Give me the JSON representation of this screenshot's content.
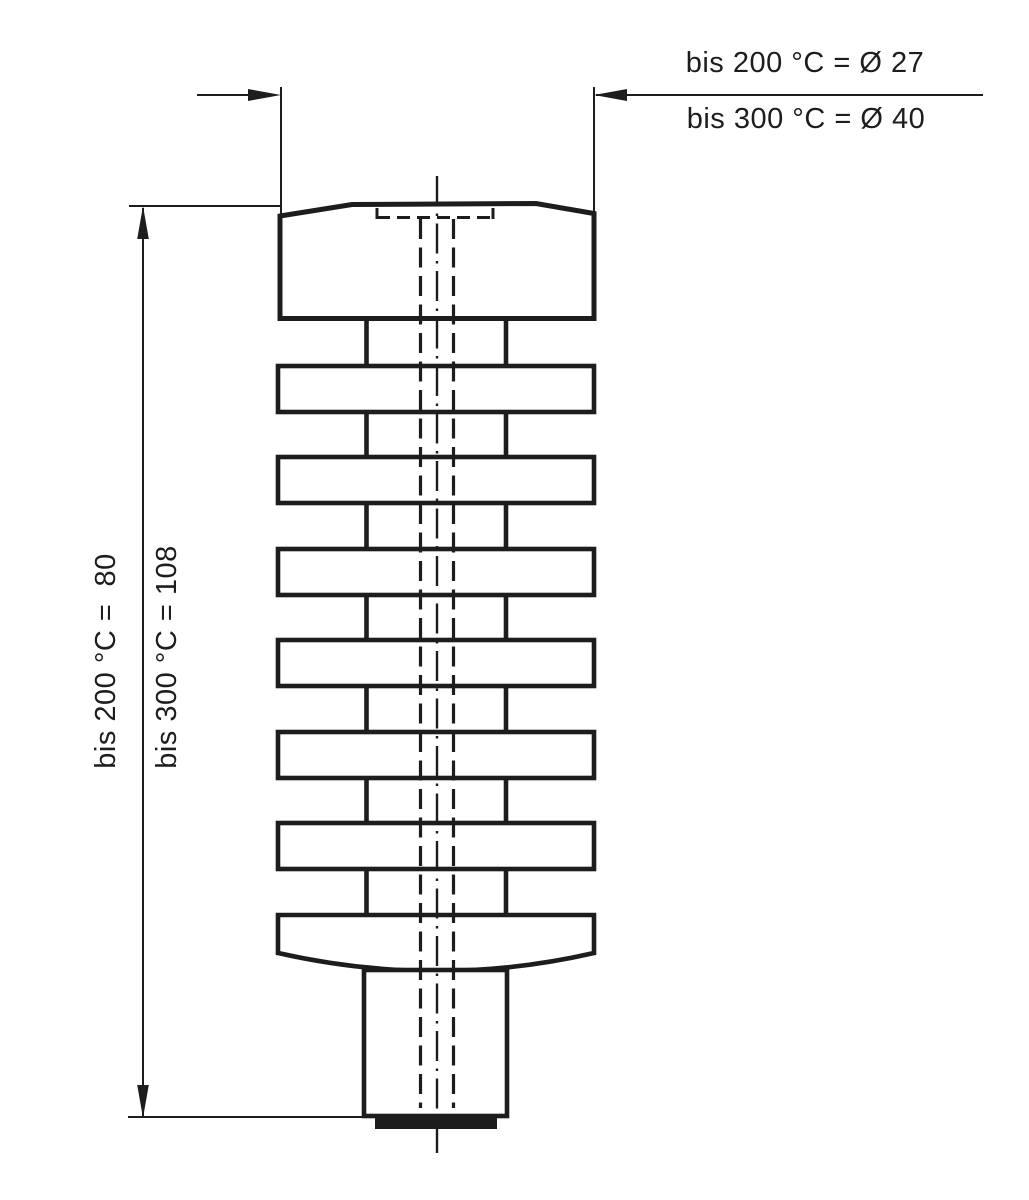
{
  "drawing": {
    "description": "technical outline drawing of a finned heating cartridge with dimension lines",
    "fin_count": 7,
    "colors": {
      "ink": "#1d1d1d",
      "background": "#ffffff"
    },
    "labels": {
      "diameter_200": "bis 200 °C = Ø 27",
      "diameter_300": "bis 300 °C = Ø 40",
      "height_200": "bis 200 °C =  80",
      "height_300": "bis 300 °C = 108"
    },
    "dimensions": {
      "diameter": [
        {
          "condition": "bis 200 °C",
          "value": "Ø 27"
        },
        {
          "condition": "bis 300 °C",
          "value": "Ø 40"
        }
      ],
      "height": [
        {
          "condition": "bis 200 °C",
          "value": "80"
        },
        {
          "condition": "bis 300 °C",
          "value": "108"
        }
      ]
    }
  }
}
